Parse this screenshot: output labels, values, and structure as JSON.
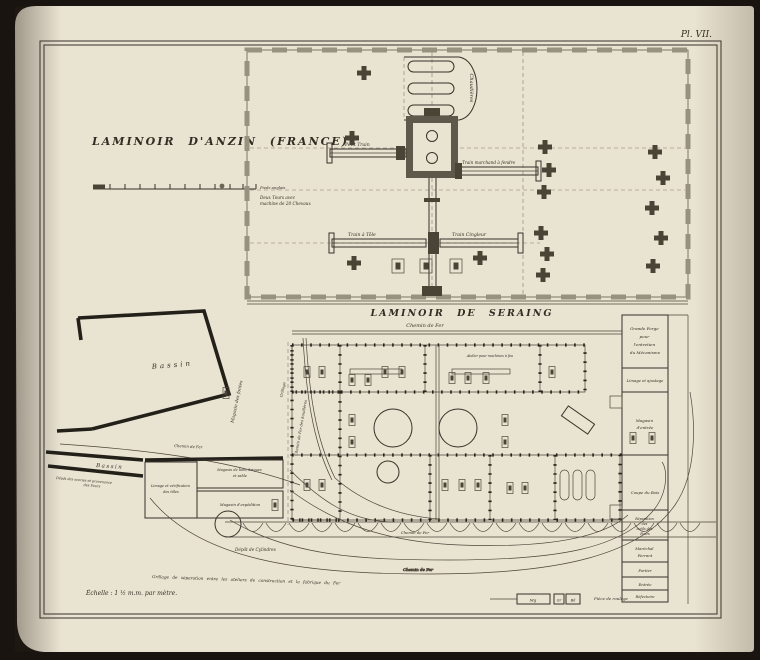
{
  "page": {
    "plate_label": "Pl. VII.",
    "colors": {
      "paper": "#e9e3d2",
      "ink": "#332d24",
      "wall_gray": "#97917f",
      "background": "#191410"
    }
  },
  "anzin": {
    "title": "LAMINOIR D'ANZIN  (FRANCE)",
    "scale_end_label": "Pieds anglais",
    "chaudieres": "Chaudières",
    "deux_tours_l1": "Deux Tours avec",
    "deux_tours_l2": "machine de 20 Chevaux",
    "petit_train": "Petit Train",
    "train_marchand": "Train marchand à fendre",
    "train_a_tole": "Train  à  Tôle",
    "train_cingleur": "Train Cingleur"
  },
  "seraing": {
    "title": "LAMINOIR DE SERAING",
    "chemin_de_fer_top": "Chemin  de  Fer",
    "chemin_de_fer_quay": "Chemin  de  Fer",
    "chemin_de_fer_shed": "Chemin  de  Fer",
    "chemin_de_fer_curve": "Chemin de Fer",
    "bassin_upper": "Bassin",
    "bassin_lower": "Bassin",
    "magasin_fontes": "Magasin  des  fontes",
    "grillage": "Grillage",
    "chemin_houilleres": "Chemin de Fer des houillères",
    "atelier_machines": "Atelier pour machines à feu",
    "depot_scories_l1": "Dépôt des scories et provenance",
    "depot_scories_l2": "des Fours",
    "limage_verif_l1": "Limage et vérification",
    "limage_verif_l2": "des tôles",
    "magasin_bois_l1": "Magasin de bois, briques",
    "magasin_bois_l2": "et sable",
    "magasin_expedition": "Magasin d'expédition",
    "depot_cylindres": "Dépôt  de  Cylindres",
    "grande_forge_l1": "Grande Forge",
    "grande_forge_l2": "pour",
    "grande_forge_l3": "l'entretien",
    "grande_forge_l4": "du Mécanisme",
    "limage_ajustage": "Limage et ajustage",
    "magasin_entree_l1": "Magasin",
    "magasin_entree_l2": "d'entrée",
    "coupe_bois": "Coupe du Bois",
    "reparation_l1": "Réparation",
    "reparation_l2": "des",
    "reparation_l3": "outils des",
    "reparation_l4": "Fours",
    "marechal_l1": "Maréchal",
    "marechal_l2": "Ferrant",
    "portier": "Portier",
    "entree": "Entrée",
    "refectoire": "Réfectoire",
    "piece_roulage": "Pièce de roulage",
    "box_mg": "Mg",
    "box_gr": "Gr",
    "box_bd": "Bd",
    "grillage_note": "Grillage de séparation entre les ateliers de construction et la fabrique du Fer",
    "scale_note": "Échelle : 1 ½ m.m. par mètre."
  }
}
